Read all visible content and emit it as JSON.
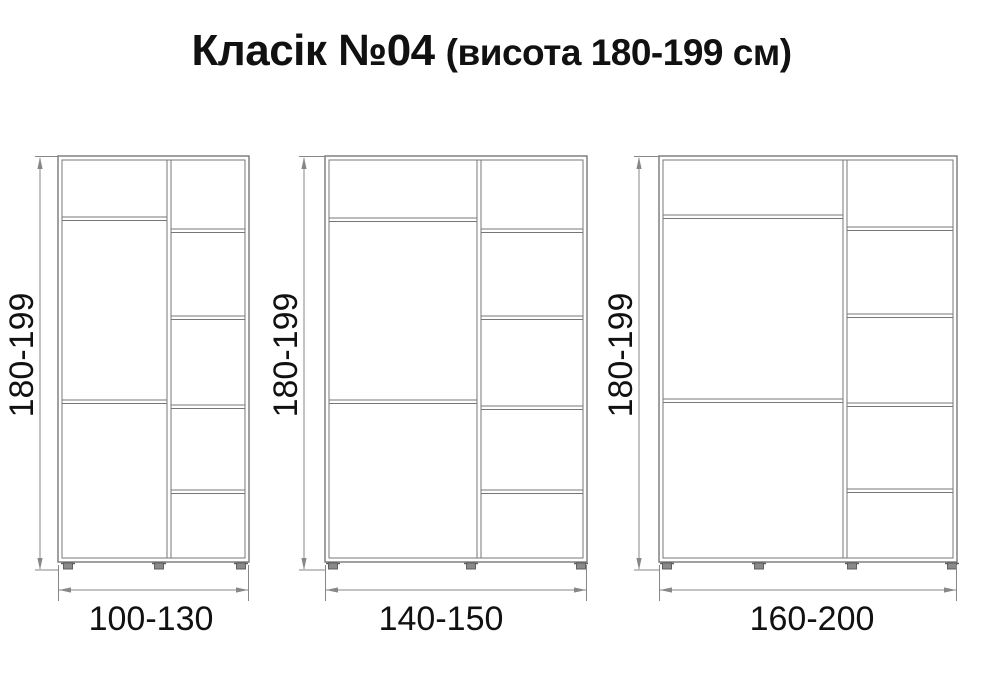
{
  "title": {
    "main": "Класік №04",
    "sub": "(висота 180-199 см)"
  },
  "colors": {
    "line": "#777777",
    "dim": "#878787",
    "foot_fill": "#8a8a8a",
    "foot_stroke": "#5f5f5f",
    "text": "#111111",
    "background": "#ffffff"
  },
  "diagram": {
    "type": "furniture-dimension-drawing",
    "unit": "см",
    "body_top_y": 156,
    "body_bottom_y": 562,
    "wall_thickness": 4,
    "wardrobes": [
      {
        "id": "wardrobe-1",
        "height_label": "180-199",
        "width_label": "100-130",
        "x_left": 58,
        "x_right": 249,
        "divider_x": 169,
        "dim_x": 40,
        "label_center_x": 151,
        "left_shelves_y": [
          217,
          400
        ],
        "right_shelves_y": [
          229,
          316,
          405,
          490
        ],
        "feet_x": [
          68,
          159,
          241
        ]
      },
      {
        "id": "wardrobe-2",
        "height_label": "180-199",
        "width_label": "140-150",
        "x_left": 325,
        "x_right": 587,
        "divider_x": 479,
        "dim_x": 304,
        "label_center_x": 441,
        "left_shelves_y": [
          218,
          400
        ],
        "right_shelves_y": [
          229,
          316,
          406,
          490
        ],
        "feet_x": [
          333,
          471,
          581
        ]
      },
      {
        "id": "wardrobe-3",
        "height_label": "180-199",
        "width_label": "160-200",
        "x_left": 659,
        "x_right": 957,
        "divider_x": 845,
        "dim_x": 639,
        "label_center_x": 812,
        "left_shelves_y": [
          215,
          399
        ],
        "right_shelves_y": [
          227,
          314,
          403,
          489
        ],
        "feet_x": [
          667,
          759,
          852,
          952
        ]
      }
    ]
  }
}
